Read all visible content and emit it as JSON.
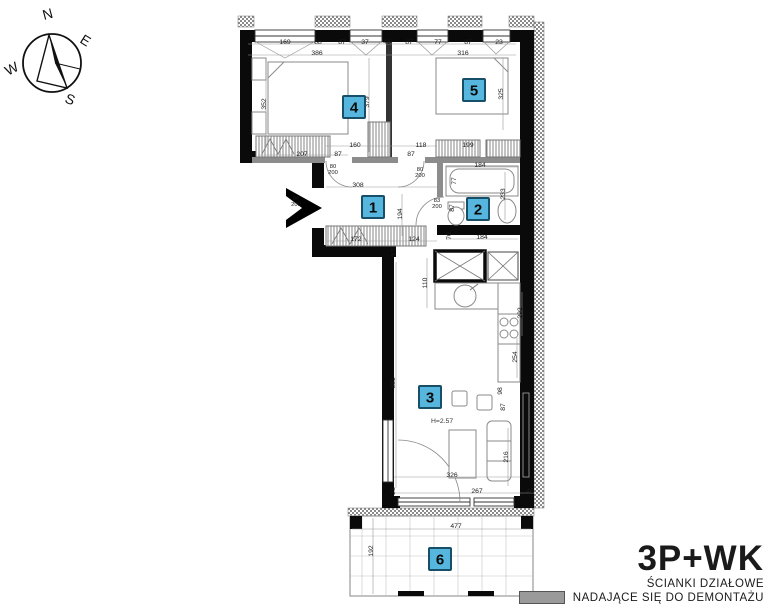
{
  "compass": {
    "n": "N",
    "e": "E",
    "s": "S",
    "w": "W"
  },
  "legend": {
    "plan_type": "3P+WK",
    "line1": "ŚCIANKI DZIAŁOWE",
    "line2": "NADAJĄCE SIĘ DO DEMONTAŻU",
    "swatch_color": "#9a9a9a"
  },
  "plan": {
    "marker_style": {
      "bg": "#57b6dd",
      "border": "#174f68",
      "text": "#0a0a0a"
    },
    "markers": [
      {
        "num": "1",
        "x": 373,
        "y": 207
      },
      {
        "num": "2",
        "x": 478,
        "y": 209
      },
      {
        "num": "3",
        "x": 430,
        "y": 397
      },
      {
        "num": "4",
        "x": 354,
        "y": 107
      },
      {
        "num": "5",
        "x": 474,
        "y": 90
      },
      {
        "num": "6",
        "x": 440,
        "y": 559
      }
    ],
    "annotations": [
      {
        "v": "H=2.57",
        "x": 431,
        "y": 423
      }
    ],
    "dimensions": [
      {
        "v": "169",
        "x": 285,
        "y": 44,
        "r": 0
      },
      {
        "v": "88",
        "x": 318,
        "y": 44,
        "r": 0
      },
      {
        "v": "87",
        "x": 342,
        "y": 44,
        "r": 0
      },
      {
        "v": "37",
        "x": 365,
        "y": 44,
        "r": 0
      },
      {
        "v": "43",
        "x": 387,
        "y": 44,
        "r": 0
      },
      {
        "v": "87",
        "x": 409,
        "y": 44,
        "r": 0
      },
      {
        "v": "77",
        "x": 438,
        "y": 44,
        "r": 0
      },
      {
        "v": "87",
        "x": 468,
        "y": 44,
        "r": 0
      },
      {
        "v": "23",
        "x": 499,
        "y": 44,
        "r": 0
      },
      {
        "v": "386",
        "x": 317,
        "y": 55,
        "r": 0
      },
      {
        "v": "316",
        "x": 463,
        "y": 55,
        "r": 0
      },
      {
        "v": "352",
        "x": 266,
        "y": 104,
        "r": -90
      },
      {
        "v": "207",
        "x": 302,
        "y": 156,
        "r": 0
      },
      {
        "v": "379",
        "x": 369,
        "y": 102,
        "r": -90
      },
      {
        "v": "325",
        "x": 503,
        "y": 94,
        "r": -90
      },
      {
        "v": "160",
        "x": 355,
        "y": 147,
        "r": 0
      },
      {
        "v": "87",
        "x": 338,
        "y": 156,
        "r": 0
      },
      {
        "v": "87",
        "x": 411,
        "y": 156,
        "r": 0
      },
      {
        "v": "118",
        "x": 421,
        "y": 147,
        "r": 0
      },
      {
        "v": "199",
        "x": 468,
        "y": 147,
        "r": 0
      },
      {
        "v": "80",
        "v2": "200",
        "x": 333,
        "y": 168,
        "r": 0
      },
      {
        "v": "80",
        "v2": "200",
        "x": 420,
        "y": 171,
        "r": 0
      },
      {
        "v": "90",
        "v2": "200",
        "x": 296,
        "y": 200,
        "r": 0
      },
      {
        "v": "83",
        "v2": "200",
        "x": 437,
        "y": 202,
        "r": 0
      },
      {
        "v": "308",
        "x": 358,
        "y": 187,
        "r": 0
      },
      {
        "v": "194",
        "x": 402,
        "y": 214,
        "r": -90
      },
      {
        "v": "172",
        "x": 356,
        "y": 241,
        "r": 0
      },
      {
        "v": "124",
        "x": 414,
        "y": 241,
        "r": 0
      },
      {
        "v": "184",
        "x": 480,
        "y": 167,
        "r": 0
      },
      {
        "v": "77",
        "x": 456,
        "y": 181,
        "r": -90
      },
      {
        "v": "87",
        "x": 454,
        "y": 208,
        "r": -90
      },
      {
        "v": "233",
        "x": 505,
        "y": 194,
        "r": -90
      },
      {
        "v": "70",
        "x": 451,
        "y": 236,
        "r": -90
      },
      {
        "v": "184",
        "x": 482,
        "y": 239,
        "r": 0
      },
      {
        "v": "37",
        "x": 396,
        "y": 253,
        "r": -90
      },
      {
        "v": "110",
        "x": 427,
        "y": 283,
        "r": -90
      },
      {
        "v": "292",
        "x": 522,
        "y": 313,
        "r": -90
      },
      {
        "v": "254",
        "x": 517,
        "y": 357,
        "r": -90
      },
      {
        "v": "881",
        "x": 395,
        "y": 383,
        "r": -90
      },
      {
        "v": "98",
        "x": 502,
        "y": 391,
        "r": -90
      },
      {
        "v": "87",
        "x": 505,
        "y": 407,
        "r": -90
      },
      {
        "v": "216",
        "x": 508,
        "y": 457,
        "r": -90
      },
      {
        "v": "326",
        "x": 452,
        "y": 477,
        "r": 0
      },
      {
        "v": "267",
        "x": 477,
        "y": 493,
        "r": 0
      },
      {
        "v": "46",
        "x": 530,
        "y": 493,
        "r": 0
      },
      {
        "v": "21",
        "x": 395,
        "y": 491,
        "r": -90
      },
      {
        "v": "477",
        "x": 456,
        "y": 528,
        "r": 0
      },
      {
        "v": "192",
        "x": 373,
        "y": 551,
        "r": -90
      }
    ]
  }
}
